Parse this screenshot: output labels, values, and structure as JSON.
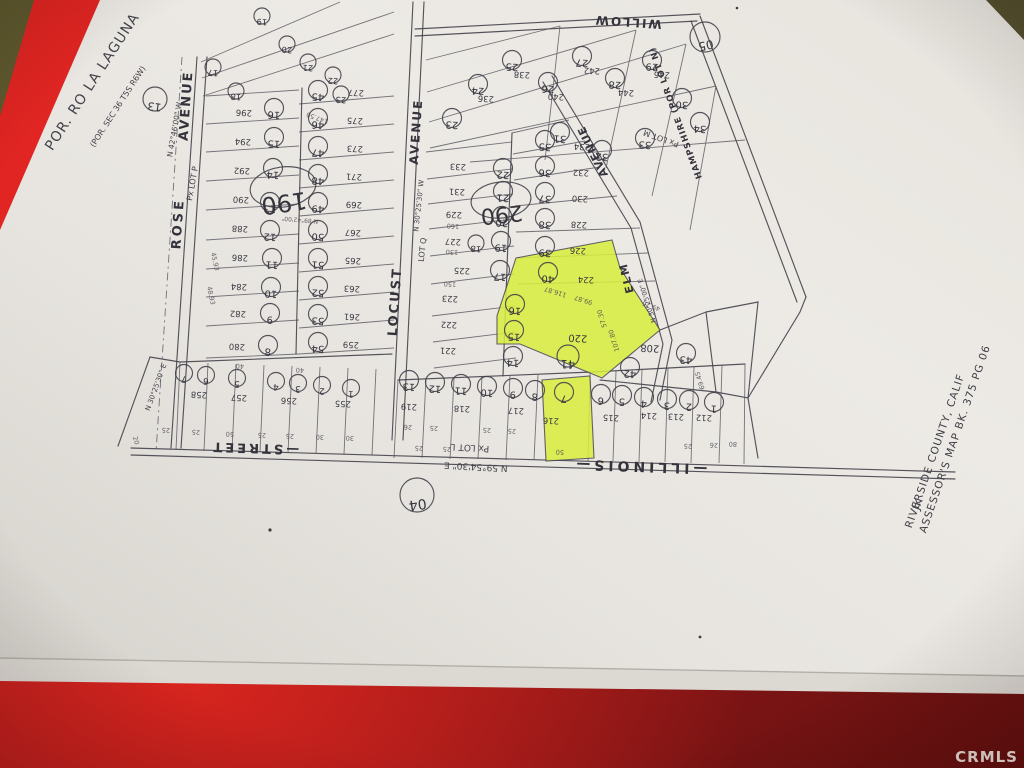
{
  "photo": {
    "watermark": "CRMLS",
    "surface_color": "#a81c1e",
    "surface_bright": "#d92523",
    "paper_color": "#eae7e2",
    "highlight_color": "#d9ee3d"
  },
  "document": {
    "corner_note_line1": "POR. RO LA LAGUNA",
    "corner_note_line2": "(POR. SEC 36 T5S R6W)",
    "title_line1": "ASSESSOR'S  MAP  BK. 375  PG 06",
    "title_line2": "RIVERSIDE  COUNTY,  CALIF",
    "title_line3": "JK"
  },
  "map": {
    "highlighted_parcels": [
      {
        "parcel": "220",
        "lot": "41"
      },
      {
        "parcel": "224",
        "lot": "40"
      },
      {
        "parcel": "216",
        "lot": "7"
      }
    ],
    "street_labels": [
      {
        "t": "ROSE",
        "x": 182,
        "y": 224,
        "r": -86,
        "fs": 13,
        "ls": 3
      },
      {
        "t": "AVENUE",
        "x": 190,
        "y": 106,
        "r": -86,
        "fs": 13,
        "ls": 2
      },
      {
        "t": "LOCUST",
        "x": 399,
        "y": 302,
        "r": -86,
        "fs": 13,
        "ls": 2
      },
      {
        "t": "AVENUE",
        "x": 420,
        "y": 132,
        "r": -86,
        "fs": 12,
        "ls": 2
      },
      {
        "t": "WILLOW",
        "x": 628,
        "y": 18,
        "r": 184,
        "fs": 12,
        "ls": 2
      },
      {
        "t": "HAMPSHIRE (POR LOT N)",
        "x": 678,
        "y": 112,
        "r": 250,
        "fs": 8.5,
        "ls": 1
      },
      {
        "t": "AVENUE",
        "x": 596,
        "y": 150,
        "r": 244,
        "fs": 11,
        "ls": 1
      },
      {
        "t": "ELM",
        "x": 630,
        "y": 277,
        "r": 256,
        "fs": 11,
        "ls": 2
      },
      {
        "t": "—ILLINOIS—",
        "x": 640,
        "y": 462,
        "r": 182,
        "fs": 14,
        "ls": 4
      },
      {
        "t": "—STREET",
        "x": 255,
        "y": 444,
        "r": 182,
        "fs": 13,
        "ls": 3
      }
    ],
    "notes": [
      {
        "t": "N 42°46'00\" W",
        "x": 177,
        "y": 130,
        "r": -80,
        "fs": 7.5
      },
      {
        "t": "Px LOT P",
        "x": 195,
        "y": 184,
        "r": -80,
        "fs": 8
      },
      {
        "t": "N 30°25'30\" W",
        "x": 421,
        "y": 206,
        "r": -84,
        "fs": 7
      },
      {
        "t": "LOT Q",
        "x": 425,
        "y": 250,
        "r": -84,
        "fs": 8
      },
      {
        "t": "N 30°25'30\" E",
        "x": 158,
        "y": 388,
        "r": -70,
        "fs": 7
      },
      {
        "t": "Px LOT L",
        "x": 470,
        "y": 445,
        "r": 183,
        "fs": 9
      },
      {
        "t": "N 59°54'30\" E",
        "x": 476,
        "y": 464,
        "r": 183,
        "fs": 9
      },
      {
        "t": "Px LOT M",
        "x": 662,
        "y": 136,
        "r": 200,
        "fs": 8
      },
      {
        "t": "N 30°25'00\" E",
        "x": 649,
        "y": 300,
        "r": 252,
        "fs": 6.5
      }
    ],
    "parcel_numbers": [
      {
        "t": "296",
        "x": 244,
        "y": 110
      },
      {
        "t": "294",
        "x": 243,
        "y": 139
      },
      {
        "t": "292",
        "x": 242,
        "y": 168
      },
      {
        "t": "290",
        "x": 241,
        "y": 197
      },
      {
        "t": "288",
        "x": 240,
        "y": 226
      },
      {
        "t": "286",
        "x": 240,
        "y": 255
      },
      {
        "t": "284",
        "x": 239,
        "y": 284
      },
      {
        "t": "282",
        "x": 238,
        "y": 311
      },
      {
        "t": "280",
        "x": 237,
        "y": 344
      },
      {
        "t": "277",
        "x": 356,
        "y": 90
      },
      {
        "t": "275",
        "x": 355,
        "y": 118
      },
      {
        "t": "273",
        "x": 355,
        "y": 146
      },
      {
        "t": "271",
        "x": 354,
        "y": 174
      },
      {
        "t": "269",
        "x": 354,
        "y": 202
      },
      {
        "t": "267",
        "x": 353,
        "y": 230
      },
      {
        "t": "265",
        "x": 353,
        "y": 258
      },
      {
        "t": "263",
        "x": 352,
        "y": 286
      },
      {
        "t": "261",
        "x": 352,
        "y": 314
      },
      {
        "t": "259",
        "x": 351,
        "y": 342
      },
      {
        "t": "233",
        "x": 458,
        "y": 164
      },
      {
        "t": "231",
        "x": 457,
        "y": 189
      },
      {
        "t": "229",
        "x": 454,
        "y": 212
      },
      {
        "t": "227",
        "x": 453,
        "y": 239
      },
      {
        "t": "225",
        "x": 462,
        "y": 268
      },
      {
        "t": "223",
        "x": 450,
        "y": 296
      },
      {
        "t": "222",
        "x": 449,
        "y": 322
      },
      {
        "t": "221",
        "x": 448,
        "y": 348
      },
      {
        "t": "234",
        "x": 582,
        "y": 144
      },
      {
        "t": "232",
        "x": 581,
        "y": 170
      },
      {
        "t": "230",
        "x": 580,
        "y": 196
      },
      {
        "t": "228",
        "x": 579,
        "y": 222
      },
      {
        "t": "226",
        "x": 578,
        "y": 248
      },
      {
        "t": "224",
        "x": 586,
        "y": 277
      },
      {
        "t": "220",
        "x": 578,
        "y": 335,
        "fs": 10
      },
      {
        "t": "208",
        "x": 650,
        "y": 345,
        "fs": 10
      },
      {
        "t": "258",
        "x": 199,
        "y": 392
      },
      {
        "t": "257",
        "x": 239,
        "y": 395
      },
      {
        "t": "256",
        "x": 289,
        "y": 398
      },
      {
        "t": "255",
        "x": 343,
        "y": 401
      },
      {
        "t": "219",
        "x": 409,
        "y": 404
      },
      {
        "t": "218",
        "x": 462,
        "y": 406
      },
      {
        "t": "217",
        "x": 516,
        "y": 408
      },
      {
        "t": "216",
        "x": 551,
        "y": 418
      },
      {
        "t": "215",
        "x": 611,
        "y": 415
      },
      {
        "t": "214",
        "x": 649,
        "y": 413
      },
      {
        "t": "213",
        "x": 676,
        "y": 414
      },
      {
        "t": "212",
        "x": 704,
        "y": 415
      },
      {
        "t": "236",
        "x": 486,
        "y": 96
      },
      {
        "t": "238",
        "x": 522,
        "y": 72
      },
      {
        "t": "240",
        "x": 556,
        "y": 94
      },
      {
        "t": "242",
        "x": 592,
        "y": 68
      },
      {
        "t": "244",
        "x": 626,
        "y": 90
      },
      {
        "t": "246",
        "x": 662,
        "y": 72
      }
    ],
    "lot_circles": [
      {
        "t": "16",
        "x": 274,
        "y": 108
      },
      {
        "t": "15",
        "x": 274,
        "y": 137
      },
      {
        "t": "14",
        "x": 273,
        "y": 168
      },
      {
        "t": "13",
        "x": 270,
        "y": 202
      },
      {
        "t": "12",
        "x": 270,
        "y": 230
      },
      {
        "t": "11",
        "x": 272,
        "y": 258
      },
      {
        "t": "10",
        "x": 271,
        "y": 287
      },
      {
        "t": "9",
        "x": 270,
        "y": 313
      },
      {
        "t": "8",
        "x": 268,
        "y": 345
      },
      {
        "t": "17",
        "x": 213,
        "y": 67,
        "rad": 8
      },
      {
        "t": "18",
        "x": 236,
        "y": 91,
        "rad": 8
      },
      {
        "t": "19",
        "x": 262,
        "y": 16,
        "rad": 8
      },
      {
        "t": "20",
        "x": 287,
        "y": 44,
        "rad": 8
      },
      {
        "t": "21",
        "x": 308,
        "y": 62,
        "rad": 8
      },
      {
        "t": "22",
        "x": 333,
        "y": 75,
        "rad": 8
      },
      {
        "t": "23",
        "x": 341,
        "y": 94,
        "rad": 8
      },
      {
        "t": "45",
        "x": 318,
        "y": 90
      },
      {
        "t": "46",
        "x": 318,
        "y": 118
      },
      {
        "t": "47",
        "x": 318,
        "y": 146
      },
      {
        "t": "48",
        "x": 318,
        "y": 174
      },
      {
        "t": "49",
        "x": 318,
        "y": 202
      },
      {
        "t": "50",
        "x": 318,
        "y": 230
      },
      {
        "t": "51",
        "x": 318,
        "y": 258
      },
      {
        "t": "52",
        "x": 318,
        "y": 286
      },
      {
        "t": "53",
        "x": 318,
        "y": 314
      },
      {
        "t": "54",
        "x": 318,
        "y": 342
      },
      {
        "t": "22",
        "x": 503,
        "y": 168
      },
      {
        "t": "21",
        "x": 503,
        "y": 191
      },
      {
        "t": "20",
        "x": 502,
        "y": 216
      },
      {
        "t": "19",
        "x": 501,
        "y": 241
      },
      {
        "t": "18",
        "x": 476,
        "y": 243,
        "rad": 8
      },
      {
        "t": "17",
        "x": 500,
        "y": 270
      },
      {
        "t": "16",
        "x": 515,
        "y": 304
      },
      {
        "t": "15",
        "x": 514,
        "y": 330
      },
      {
        "t": "14",
        "x": 513,
        "y": 356
      },
      {
        "t": "35",
        "x": 545,
        "y": 140
      },
      {
        "t": "36",
        "x": 545,
        "y": 166
      },
      {
        "t": "37",
        "x": 545,
        "y": 192
      },
      {
        "t": "38",
        "x": 545,
        "y": 218
      },
      {
        "t": "39",
        "x": 545,
        "y": 246
      },
      {
        "t": "40",
        "x": 548,
        "y": 272
      },
      {
        "t": "41",
        "x": 568,
        "y": 356,
        "rad": 11
      },
      {
        "t": "42",
        "x": 630,
        "y": 367
      },
      {
        "t": "43",
        "x": 686,
        "y": 353
      },
      {
        "t": "23",
        "x": 452,
        "y": 118
      },
      {
        "t": "24",
        "x": 478,
        "y": 84
      },
      {
        "t": "25",
        "x": 512,
        "y": 60
      },
      {
        "t": "26",
        "x": 548,
        "y": 82
      },
      {
        "t": "27",
        "x": 582,
        "y": 56
      },
      {
        "t": "28",
        "x": 615,
        "y": 78
      },
      {
        "t": "29",
        "x": 652,
        "y": 60
      },
      {
        "t": "30",
        "x": 682,
        "y": 98
      },
      {
        "t": "31",
        "x": 560,
        "y": 132
      },
      {
        "t": "32",
        "x": 602,
        "y": 150
      },
      {
        "t": "33",
        "x": 645,
        "y": 138
      },
      {
        "t": "34",
        "x": 700,
        "y": 122
      },
      {
        "t": "7",
        "x": 184,
        "y": 373,
        "rad": 8.5
      },
      {
        "t": "6",
        "x": 206,
        "y": 375,
        "rad": 8.5
      },
      {
        "t": "5",
        "x": 237,
        "y": 378,
        "rad": 8.5
      },
      {
        "t": "4",
        "x": 276,
        "y": 381,
        "rad": 8.5
      },
      {
        "t": "3",
        "x": 298,
        "y": 383,
        "rad": 8.5
      },
      {
        "t": "2",
        "x": 322,
        "y": 385,
        "rad": 8.5
      },
      {
        "t": "1",
        "x": 351,
        "y": 388,
        "rad": 8.5
      },
      {
        "t": "13",
        "x": 409,
        "y": 380
      },
      {
        "t": "12",
        "x": 435,
        "y": 382
      },
      {
        "t": "11",
        "x": 461,
        "y": 384
      },
      {
        "t": "10",
        "x": 487,
        "y": 386
      },
      {
        "t": "9",
        "x": 513,
        "y": 388
      },
      {
        "t": "8",
        "x": 535,
        "y": 390
      },
      {
        "t": "7",
        "x": 564,
        "y": 392
      },
      {
        "t": "6",
        "x": 601,
        "y": 394
      },
      {
        "t": "5",
        "x": 622,
        "y": 395
      },
      {
        "t": "4",
        "x": 644,
        "y": 397
      },
      {
        "t": "3",
        "x": 667,
        "y": 399
      },
      {
        "t": "2",
        "x": 689,
        "y": 400
      },
      {
        "t": "1",
        "x": 714,
        "y": 402
      }
    ],
    "section_circles": [
      {
        "t": "13",
        "x": 155,
        "y": 99,
        "rad": 12,
        "fs": 11,
        "r": 188
      },
      {
        "t": "04",
        "x": 417,
        "y": 495,
        "rad": 17,
        "fs": 14,
        "r": 172
      },
      {
        "t": "05",
        "x": 705,
        "y": 37,
        "rad": 15,
        "fs": 12,
        "r": 168
      }
    ],
    "block_ellipses": [
      {
        "t": "190",
        "x": 283,
        "y": 187,
        "rx": 33,
        "ry": 20,
        "r": 172,
        "fs": 24
      },
      {
        "t": "290",
        "x": 501,
        "y": 200,
        "rx": 30,
        "ry": 18,
        "r": 174,
        "fs": 22
      }
    ],
    "dim_labels": [
      {
        "t": "25",
        "x": 166,
        "y": 428
      },
      {
        "t": "25",
        "x": 196,
        "y": 430
      },
      {
        "t": "50",
        "x": 230,
        "y": 432
      },
      {
        "t": "25",
        "x": 262,
        "y": 433
      },
      {
        "t": "25",
        "x": 290,
        "y": 434
      },
      {
        "t": "30",
        "x": 320,
        "y": 435
      },
      {
        "t": "30",
        "x": 350,
        "y": 436
      },
      {
        "t": "20",
        "x": 134,
        "y": 441,
        "r": 75
      },
      {
        "t": "25",
        "x": 419,
        "y": 446
      },
      {
        "t": "25",
        "x": 447,
        "y": 447
      },
      {
        "t": "50",
        "x": 560,
        "y": 450
      },
      {
        "t": "25",
        "x": 688,
        "y": 444
      },
      {
        "t": "26",
        "x": 714,
        "y": 443
      },
      {
        "t": "80",
        "x": 733,
        "y": 442
      },
      {
        "t": "116.87",
        "x": 556,
        "y": 290,
        "r": 197
      },
      {
        "t": "99.87",
        "x": 584,
        "y": 298,
        "r": 197
      },
      {
        "t": "107.80",
        "x": 616,
        "y": 340,
        "r": 253
      },
      {
        "t": "49.25",
        "x": 652,
        "y": 304,
        "r": 200
      },
      {
        "t": "69.45",
        "x": 702,
        "y": 380,
        "r": 253
      },
      {
        "t": "57.30",
        "x": 604,
        "y": 318,
        "r": 253
      },
      {
        "t": "130",
        "x": 452,
        "y": 250,
        "r": 183
      },
      {
        "t": "150",
        "x": 450,
        "y": 282,
        "r": 183
      },
      {
        "t": "160",
        "x": 453,
        "y": 224,
        "r": 183
      },
      {
        "t": "147.50",
        "x": 318,
        "y": 116,
        "r": 200
      },
      {
        "t": "45.93",
        "x": 213,
        "y": 262,
        "r": 78
      },
      {
        "t": "48.93",
        "x": 209,
        "y": 296,
        "r": 78
      },
      {
        "t": "40",
        "x": 240,
        "y": 364
      },
      {
        "t": "40",
        "x": 300,
        "y": 368
      },
      {
        "t": "26",
        "x": 408,
        "y": 425
      },
      {
        "t": "25",
        "x": 434,
        "y": 426
      },
      {
        "t": "25",
        "x": 487,
        "y": 428
      },
      {
        "t": "25",
        "x": 512,
        "y": 429
      },
      {
        "t": "N 89°42'00\"",
        "x": 300,
        "y": 218,
        "r": 185,
        "fs": 6
      }
    ],
    "title_lines": [
      {
        "bind": "document.title_line1",
        "x": 958,
        "y": 440,
        "r": -71,
        "fs": 10.5
      },
      {
        "bind": "document.title_line2",
        "x": 938,
        "y": 452,
        "r": -71,
        "fs": 10.5
      },
      {
        "bind": "document.title_line3",
        "x": 921,
        "y": 505,
        "r": -71,
        "fs": 10.5
      }
    ],
    "corner_note": [
      {
        "bind": "document.corner_note_line1",
        "x": 96,
        "y": 84,
        "r": -57,
        "fs": 14,
        "ls": 1
      },
      {
        "bind": "document.corner_note_line2",
        "x": 120,
        "y": 108,
        "r": -57,
        "fs": 8
      }
    ]
  }
}
